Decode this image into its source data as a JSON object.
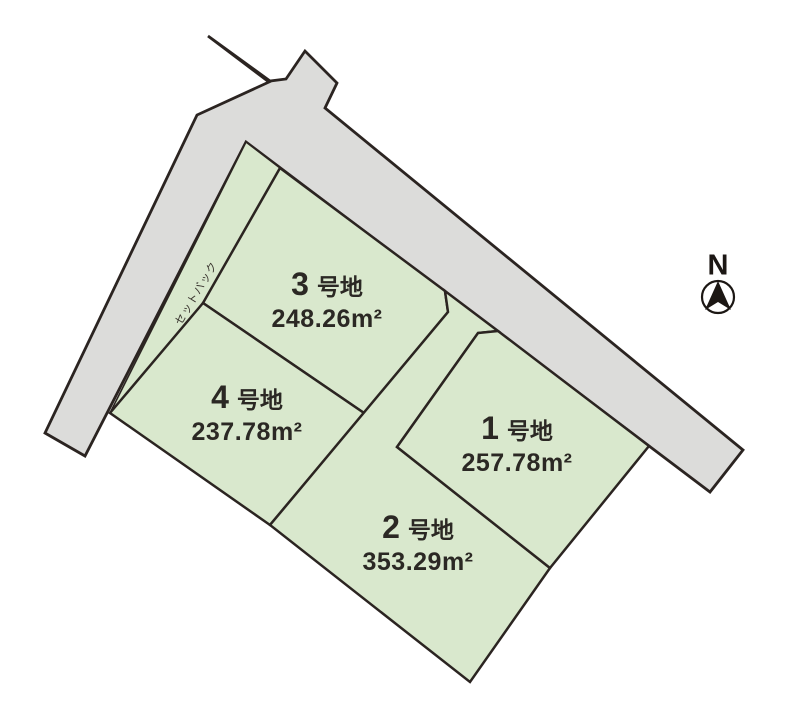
{
  "map": {
    "type": "land-subdivision-map",
    "north_label": "N",
    "setback_label": "セットバック",
    "plots": [
      {
        "number": "1",
        "suffix": "号地",
        "area": "257.78m²"
      },
      {
        "number": "2",
        "suffix": "号地",
        "area": "353.29m²"
      },
      {
        "number": "3",
        "suffix": "号地",
        "area": "248.26m²"
      },
      {
        "number": "4",
        "suffix": "号地",
        "area": "237.78m²"
      }
    ],
    "colors": {
      "plot_fill": "#d9e8cd",
      "road_fill": "#dcdcda",
      "outline": "#2b2421",
      "label_text": "#2b2824",
      "background": "#ffffff"
    }
  }
}
